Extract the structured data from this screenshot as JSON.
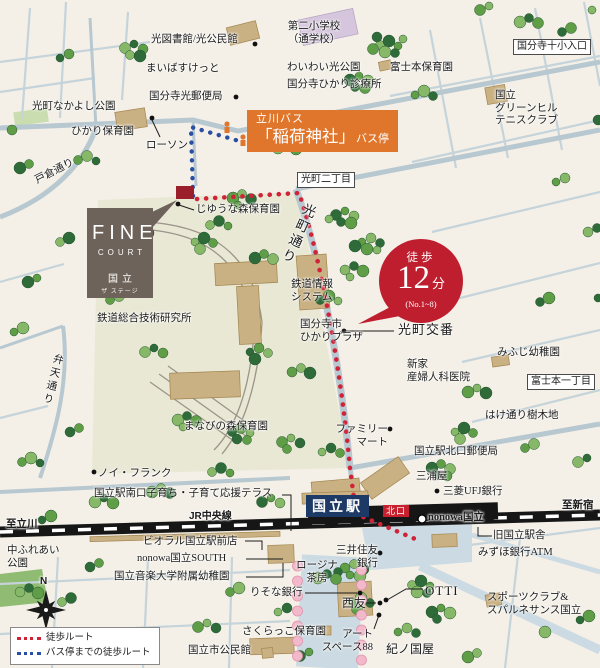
{
  "property": {
    "brand_main": "FINE",
    "brand_sub": "COURT",
    "name": "国立",
    "name_sub": "ザ ステージ"
  },
  "bus_stop": {
    "line": "立川バス",
    "name": "「稲荷神社」",
    "type": "バス停"
  },
  "badge": {
    "label": "徒歩",
    "minutes": "12",
    "unit": "分",
    "note": "(No.1~8)"
  },
  "station": {
    "name": "国立駅",
    "gate": "北口",
    "nonowa": "nonowa国立"
  },
  "directions": {
    "west": "至立川",
    "east": "至新宿"
  },
  "roads": {
    "tokura": "戸倉通り",
    "hikarimachi": "光町通り",
    "benten": "弁天通り",
    "jr_chuo": "JR中央線"
  },
  "districts": {
    "hikaricho2": "光町二丁目",
    "kokubunji10_iriguchi": "国分寺十小入口",
    "fujimoto1": "富士本一丁目"
  },
  "legend": {
    "walk_route": "徒歩ルート",
    "bus_walk_route": "バス停までの徒歩ルート"
  },
  "compass": {
    "north": "N"
  },
  "colors": {
    "walk_route": "#cf2438",
    "bus_route": "#2a4fa2",
    "badge": "#bf1e2e",
    "bus_stop_box": "#e0762b",
    "station_box": "#1d3a66",
    "north_gate_box": "#c8202e"
  },
  "pois": {
    "hikari_library": {
      "text": "光図書館/光公民館"
    },
    "daini_shogakko": {
      "text": "第二小学校\n（通学校）"
    },
    "maibasket": {
      "text": "まいばすけっと"
    },
    "waiwai_park": {
      "text": "わいわい光公園"
    },
    "fujimoto_hoikuen": {
      "text": "富士本保育園"
    },
    "hikari_post": {
      "text": "国分寺光郵便局"
    },
    "hikari_clinic": {
      "text": "国分寺ひかり診療所"
    },
    "greenhill_tennis": {
      "text": "国立\nグリーンヒル\nテニスクラブ"
    },
    "nakayoshi_park": {
      "text": "光町なかよし公園"
    },
    "hikari_hoikuen": {
      "text": "ひかり保育園"
    },
    "lawson": {
      "text": "ローソン"
    },
    "jiyuna_mori": {
      "text": "じゆうな森保育園"
    },
    "tetsudo_joho": {
      "text": "鉄道情報\nシステム"
    },
    "tetsudo_research": {
      "text": "鉄道総合技術研究所"
    },
    "hikari_plaza": {
      "text": "国分寺市\nひかりプラザ"
    },
    "hikaricho_koban": {
      "text": "光町交番"
    },
    "mifuji_yochien": {
      "text": "みふじ幼稚園"
    },
    "araya_clinic": {
      "text": "新家\n産婦人科医院"
    },
    "hake_dori_jumokuchi": {
      "text": "はけ通り樹木地"
    },
    "manabi_mori": {
      "text": "まなびの森保育園"
    },
    "familymart": {
      "text": "ファミリー\nマート"
    },
    "noi_frank": {
      "text": "ノイ・フランク"
    },
    "kitaguchi_post": {
      "text": "国立駅北口郵便局"
    },
    "miuraya": {
      "text": "三浦屋"
    },
    "mitsubishi_ufj": {
      "text": "三菱UFJ銀行"
    },
    "kyu_kunitachi_ekisha": {
      "text": "旧国立駅舎"
    },
    "mizuho_atm": {
      "text": "みずほ銀行ATM"
    },
    "smbc": {
      "text": "三井住友\n銀行"
    },
    "rojina": {
      "text": "ロージナ\n茶房"
    },
    "resona": {
      "text": "りそな銀行"
    },
    "seiyu": {
      "text": "西友"
    },
    "otti": {
      "text": "OTTI"
    },
    "sports_club": {
      "text": "スポーツクラブ&\nスパルネサンス国立"
    },
    "art_space": {
      "text": "アート\nスペース88"
    },
    "kinokuniya": {
      "text": "紀ノ国屋"
    },
    "sakurakko": {
      "text": "さくらっこ保育園"
    },
    "kunitachi_kouminkan": {
      "text": "国立市公民館"
    },
    "naka_fureai_park": {
      "text": "中ふれあい\n公園"
    },
    "minamiguchi_terrace": {
      "text": "国立駅南口子育ち・子育て応援テラス"
    },
    "bioral": {
      "text": "ビオラル国立駅前店"
    },
    "nonowa_south": {
      "text": "nonowa国立SOUTH"
    },
    "ongaku_yochien": {
      "text": "国立音楽大学附属幼稚園"
    }
  }
}
